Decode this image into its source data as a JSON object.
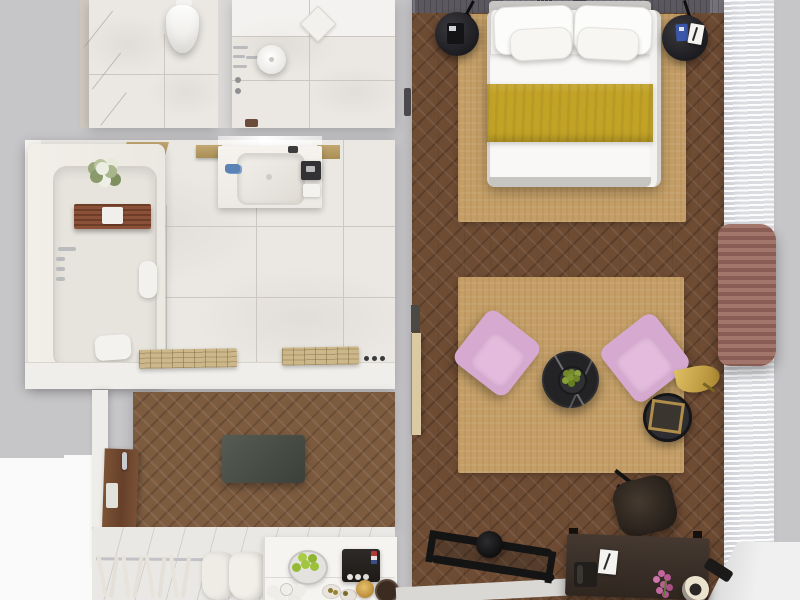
{
  "scene": {
    "description": "Top-down 3D rendered floor plan of a one-bedroom hotel suite: WC, shower room, bathroom with tub and vanity, entry hall with TV panel, wardrobe and minibar, and a combined bedroom-lounge with double bed, pink armchairs, coffee table, desk and window curtains",
    "view": "top-down",
    "visible_text": []
  },
  "palette": {
    "background": "#c6c5c8",
    "outside_light": "#fafafa",
    "marble_floor": "#ebe8e3",
    "parquet_bedroom": "#6e4b33",
    "parquet_entry": "#7d5b3f",
    "entry_tile": "#eae8e4",
    "rug_beige": "#c49e66",
    "bed_linen": "#f3f2f0",
    "runner_mustard": "#c3a326",
    "armchair_pink": "#d6aad0",
    "coffee_table_black": "#232326",
    "gold_lamp": "#cfa94a",
    "drape_mauve": "#9a6f66",
    "sheer_curtain": "#eceef1",
    "desk_brown": "#382d25",
    "tv_panel": "#474c45",
    "entry_door_wood": "#7a5136",
    "apples_green": "#a2c53e",
    "headboard_wall": "#76747a",
    "bath_caddy_wood": "#8a5138"
  },
  "rooms": {
    "wc": {
      "furniture": [
        "toilet",
        "flush-plate",
        "marble-tiles"
      ]
    },
    "shower_room": {
      "furniture": [
        "rain-shower-head",
        "shower-arm",
        "wall-bars",
        "valve-knobs",
        "floor-drain"
      ]
    },
    "bathroom": {
      "furniture": [
        "bathtub",
        "tub-caddy-tray",
        "caddy-towel",
        "flower-bouquet",
        "tub-faucet",
        "tub-drain",
        "headrest-towel",
        "bath-pillow",
        "vanity-counter",
        "sink-basin",
        "vanity-faucet",
        "blue-toiletries",
        "amenity-tray",
        "amenity-box",
        "wall-shelves",
        "slatted-towel-racks",
        "wall-hooks"
      ]
    },
    "entry_hall": {
      "furniture": [
        "entry-door",
        "door-handle",
        "door-plate",
        "tv-panel",
        "wardrobe-rail",
        "hangers",
        "bathrobes",
        "minibar-counter",
        "apple-bowl",
        "coffee-machine",
        "water-glasses",
        "snack-bowls",
        "plates"
      ]
    },
    "bedroom_lounge": {
      "furniture": [
        "headboard-wall",
        "reading-lamp-left",
        "reading-lamp-right",
        "wall-vents",
        "double-bed",
        "pillows",
        "duvet",
        "mustard-runner",
        "nightstand-left",
        "phone-dock",
        "nightstand-right",
        "blue-book",
        "notepad",
        "bed-rug",
        "lounge-rug",
        "armchair-left",
        "armchair-right",
        "coffee-table",
        "fruit-bowl",
        "floor-lamp",
        "side-table",
        "picture-frame",
        "open-door-leaf",
        "wall-switch",
        "desk",
        "desk-phone",
        "desk-notepad",
        "flower-vase",
        "desk-lamp",
        "desk-tray",
        "desk-chair",
        "luggage-rack",
        "floor-spot",
        "sheer-curtain",
        "accent-drape",
        "window-sill"
      ]
    }
  },
  "counts": {
    "pillows": 4,
    "armchairs": 2,
    "hangers": 8,
    "apples_in_bowl": 5,
    "glasses": 5,
    "nightstands": 2,
    "towel_racks": 2
  }
}
